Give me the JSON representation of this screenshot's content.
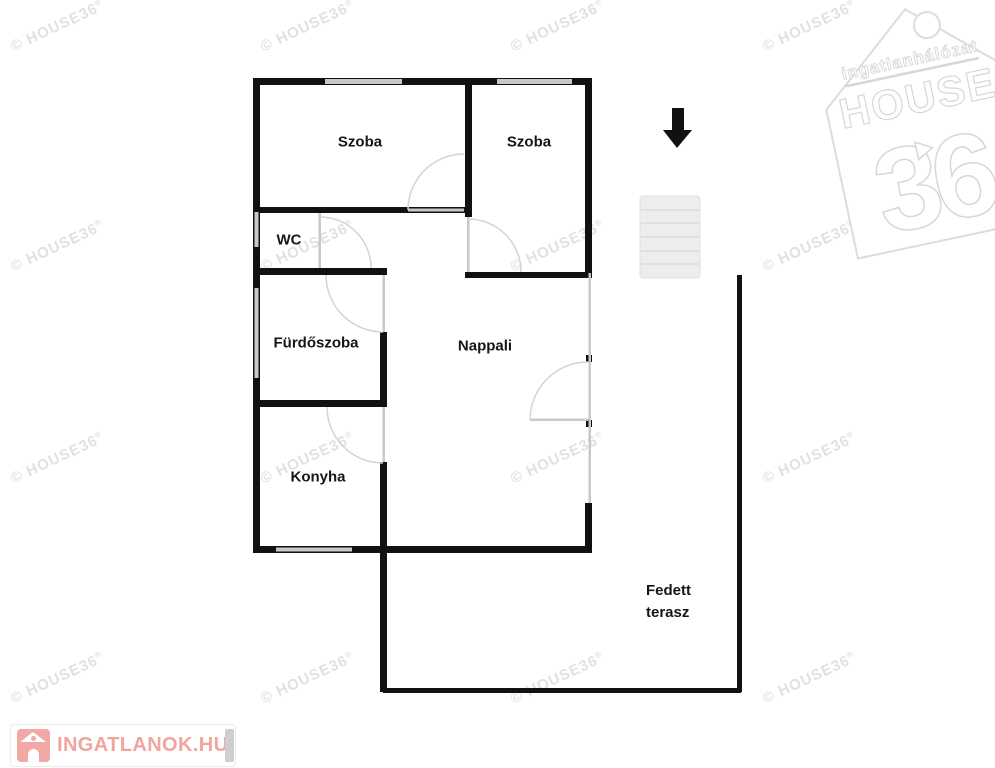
{
  "watermark": {
    "text": "© HOUSE36",
    "reg": "®"
  },
  "rooms": {
    "szoba_left": "Szoba",
    "szoba_right": "Szoba",
    "wc": "WC",
    "furdoszoba": "Fürdőszoba",
    "nappali": "Nappali",
    "konyha": "Konyha",
    "terasz": {
      "line1": "Fedett",
      "line2": "terasz"
    }
  },
  "logos": {
    "house36": {
      "tagline": "ingatlanhálózat",
      "name": "HOUSE",
      "number": "36"
    },
    "ingatlanok": {
      "text": "INGATLANOK.HU"
    }
  },
  "colors": {
    "wall": "#111111",
    "window_opening": "#c9c9c9",
    "door_arc": "#d4d4d4",
    "watermark_gray": "#e1e1e1",
    "logo_outline": "#d7d7d7",
    "brand_pink": "#f0a5a1",
    "stairs_fill": "#ededed"
  }
}
